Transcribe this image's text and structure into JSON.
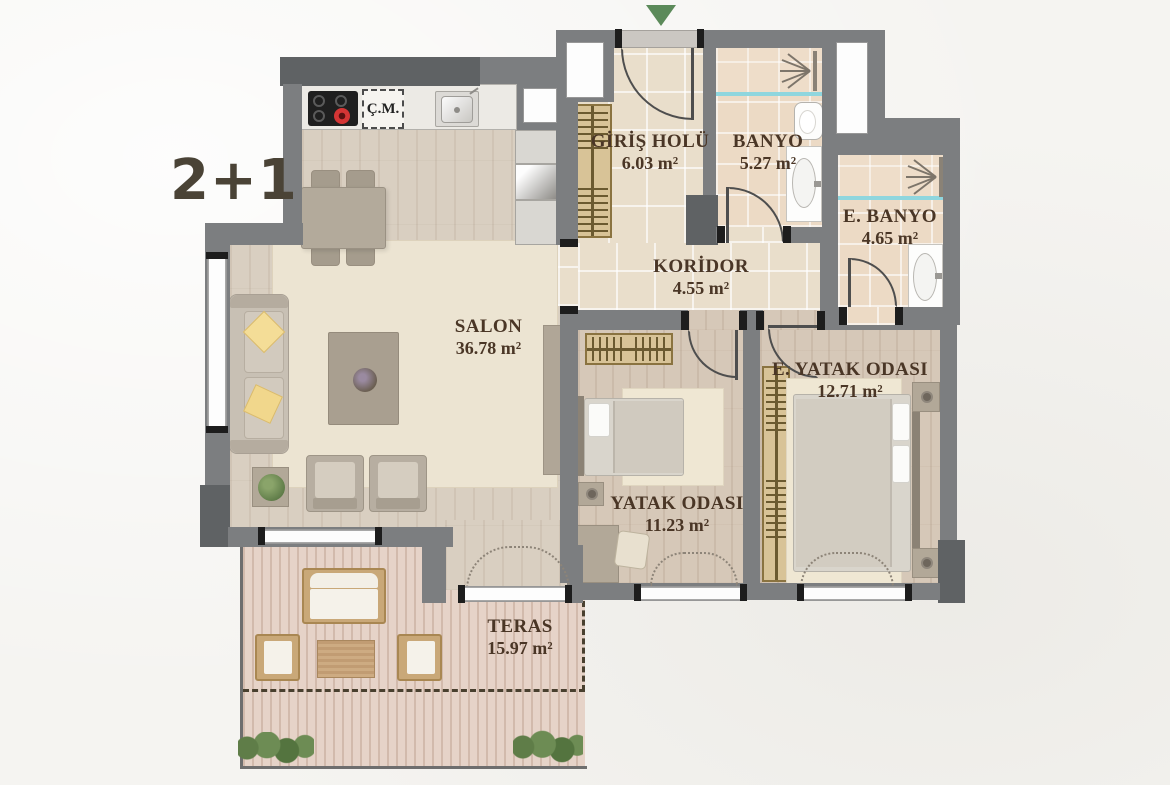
{
  "plan": {
    "type_label": "2+1",
    "rooms": {
      "giris_holu": {
        "name": "GİRİŞ HOLÜ",
        "area": "6.03 m²"
      },
      "banyo": {
        "name": "BANYO",
        "area": "5.27 m²"
      },
      "e_banyo": {
        "name": "E. BANYO",
        "area": "4.65 m²"
      },
      "koridor": {
        "name": "KORİDOR",
        "area": "4.55 m²"
      },
      "salon": {
        "name": "SALON",
        "area": "36.78 m²"
      },
      "yatak_odasi": {
        "name": "YATAK ODASI",
        "area": "11.23 m²"
      },
      "e_yatak_odasi": {
        "name": "E. YATAK ODASI",
        "area": "12.71 m²"
      },
      "teras": {
        "name": "TERAS",
        "area": "15.97 m²"
      }
    },
    "kitchen": {
      "washer_label": "Ç.M."
    },
    "colors": {
      "wall": "#7c7e80",
      "wall_dark": "#5f6264",
      "label_text": "#4a3626",
      "entrance_arrow_green": "#5c8a5a",
      "shower_glass": "#8fd6de",
      "pillow_yellow": "#f4dd97"
    }
  }
}
